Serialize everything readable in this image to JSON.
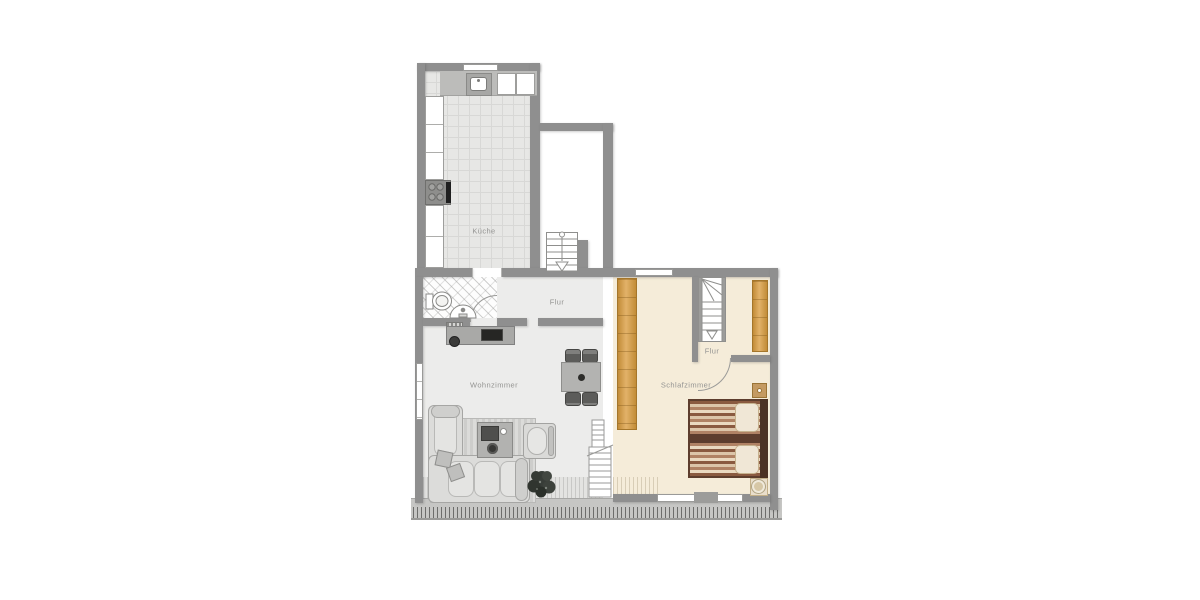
{
  "rooms": {
    "kitchen": {
      "label": "Küche"
    },
    "hall": {
      "label": "Flur"
    },
    "living": {
      "label": "Wohnzimmer"
    },
    "bedroom": {
      "label": "Schlafzimmer"
    },
    "bedroom_hall": {
      "label": "Flur"
    }
  },
  "palette": {
    "wall": "#8f8f8f",
    "kitchen_floor": "#e7e7e5",
    "hall_floor": "#ececeb",
    "bedroom_floor": "#f5ecd9",
    "wardrobe_wood": "#d9a254",
    "bed_frame": "#5d3d2d",
    "balcony": "#c6c6c4"
  },
  "furniture": [
    "kitchen-counter",
    "kitchen-sink",
    "stove",
    "toilet",
    "washbasin",
    "tv-sideboard",
    "radiator",
    "desk-chair",
    "dining-table",
    "dining-chair",
    "corner-sofa",
    "coffee-table",
    "armchair",
    "rug",
    "plant",
    "staircase-down",
    "staircase-bedroom",
    "ladder-stair",
    "wardrobe",
    "double-bed",
    "nightstand",
    "balcony-railing"
  ]
}
